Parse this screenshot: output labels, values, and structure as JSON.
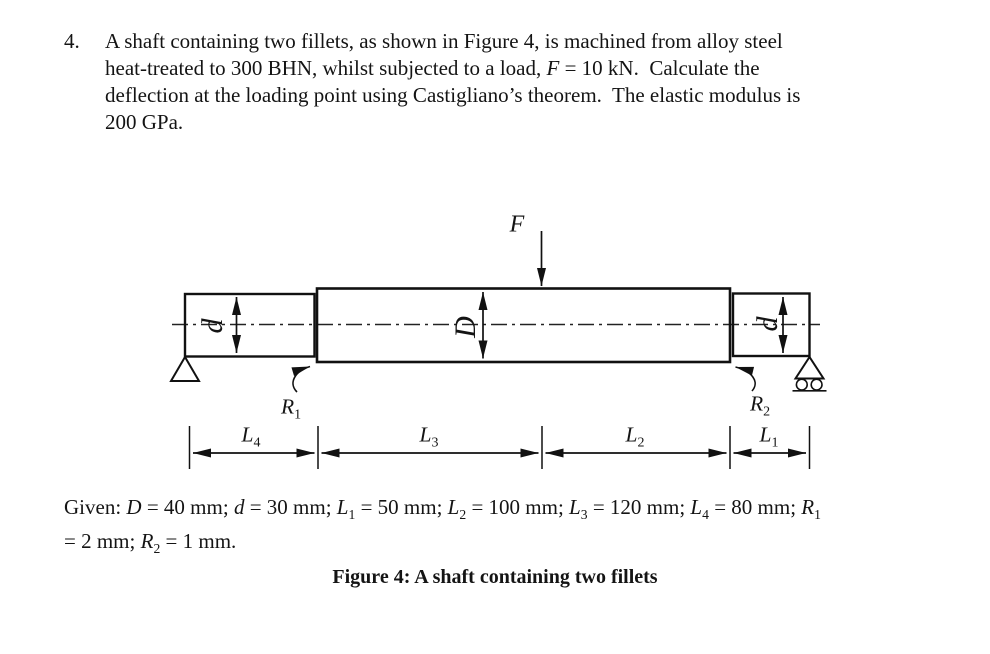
{
  "problem": {
    "number": "4.",
    "lines": [
      [
        {
          "t": "A shaft containing two fillets, as shown in Figure 4, is machined from alloy steel"
        }
      ],
      [
        {
          "t": "heat-treated to 300 BHN, whilst subjected to a load, "
        },
        {
          "t": "F",
          "i": true
        },
        {
          "t": " = 10 kN.  Calculate the"
        }
      ],
      [
        {
          "t": "deflection at the loading point using Castigliano’s theorem.  The elastic modulus is"
        }
      ],
      [
        {
          "t": "200 GPa."
        }
      ]
    ]
  },
  "figure": {
    "force_label": [
      {
        "t": "F",
        "i": true
      }
    ],
    "dia_small_left": [
      {
        "t": "d",
        "i": true
      }
    ],
    "dia_large": [
      {
        "t": "D",
        "i": true
      }
    ],
    "dia_small_right": [
      {
        "t": "d",
        "i": true
      }
    ],
    "fillet_r1": [
      {
        "t": "R",
        "i": true
      },
      {
        "t": "1",
        "sub": true
      }
    ],
    "fillet_r2": [
      {
        "t": "R",
        "i": true
      },
      {
        "t": "2",
        "sub": true
      }
    ],
    "len_l4": [
      {
        "t": "L",
        "i": true
      },
      {
        "t": "4",
        "sub": true
      }
    ],
    "len_l3": [
      {
        "t": "L",
        "i": true
      },
      {
        "t": "3",
        "sub": true
      }
    ],
    "len_l2": [
      {
        "t": "L",
        "i": true
      },
      {
        "t": "2",
        "sub": true
      }
    ],
    "len_l1": [
      {
        "t": "L",
        "i": true
      },
      {
        "t": "1",
        "sub": true
      }
    ]
  },
  "given": {
    "lines": [
      [
        {
          "t": "Given: "
        },
        {
          "t": "D",
          "i": true
        },
        {
          "t": " = 40 mm; "
        },
        {
          "t": "d",
          "i": true
        },
        {
          "t": " = 30 mm; "
        },
        {
          "t": "L",
          "i": true
        },
        {
          "t": "1",
          "sub": true
        },
        {
          "t": " = 50 mm; "
        },
        {
          "t": "L",
          "i": true
        },
        {
          "t": "2",
          "sub": true
        },
        {
          "t": " = 100 mm; "
        },
        {
          "t": "L",
          "i": true
        },
        {
          "t": "3",
          "sub": true
        },
        {
          "t": " = 120 mm; "
        },
        {
          "t": "L",
          "i": true
        },
        {
          "t": "4",
          "sub": true
        },
        {
          "t": " = 80 mm; "
        },
        {
          "t": "R",
          "i": true
        },
        {
          "t": "1",
          "sub": true
        }
      ],
      [
        {
          "t": "= 2 mm; "
        },
        {
          "t": "R",
          "i": true
        },
        {
          "t": "2",
          "sub": true
        },
        {
          "t": " = 1 mm."
        }
      ]
    ]
  },
  "caption": "Figure 4: A shaft containing two fillets",
  "colors": {
    "ink": "#111111",
    "background": "#ffffff"
  }
}
